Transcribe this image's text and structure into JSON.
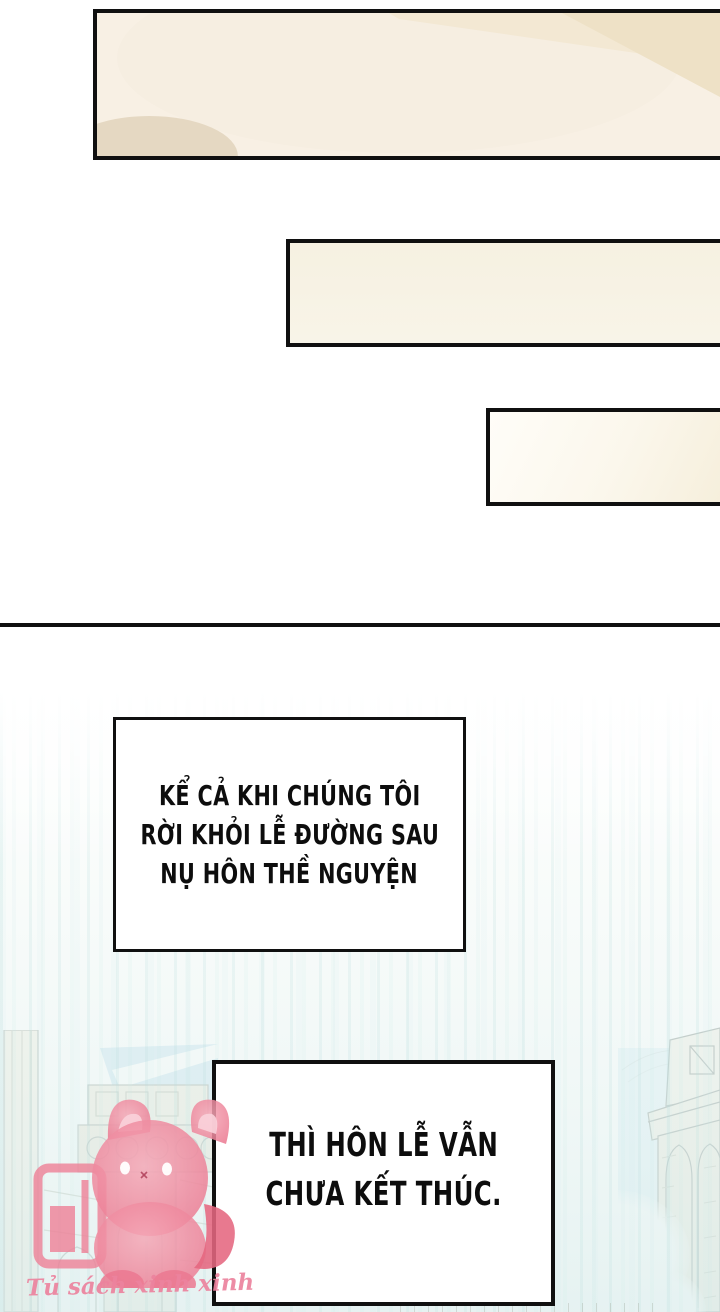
{
  "page": {
    "kind": "webtoon comic page",
    "language": "Vietnamese"
  },
  "captions": {
    "top": {
      "lines": [
        "KỂ CẢ KHI CHÚNG TÔI",
        "RỜI KHỎI LỄ ĐƯỜNG SAU",
        "NỤ HÔN THỀ NGUYỆN"
      ]
    },
    "bottom": {
      "lines": [
        "THÌ HÔN LỄ VẪN",
        "CHƯA KẾT THÚC."
      ]
    }
  },
  "watermark": {
    "text": "Tủ sách xinh xinh",
    "logo_icon": "pink-cat-with-bookshelf-icon"
  },
  "background": {
    "scene": "faded line-art of cathedral towers with pale blue sky, clouds and vertical light streaks"
  },
  "colors": {
    "panel_border": "#101010",
    "panel_cream": "#f8f0e4",
    "panel_cream_dark": "#eee1c6",
    "panel_oval_beige": "#e5d8c2",
    "watermark_pink": "#ee859c",
    "watermark_pink_dark": "#e66d88",
    "sky_blue": "#d5eaf5",
    "streak_teal": "#cfe8e5",
    "lineart_gray": "#a3aaa4"
  }
}
